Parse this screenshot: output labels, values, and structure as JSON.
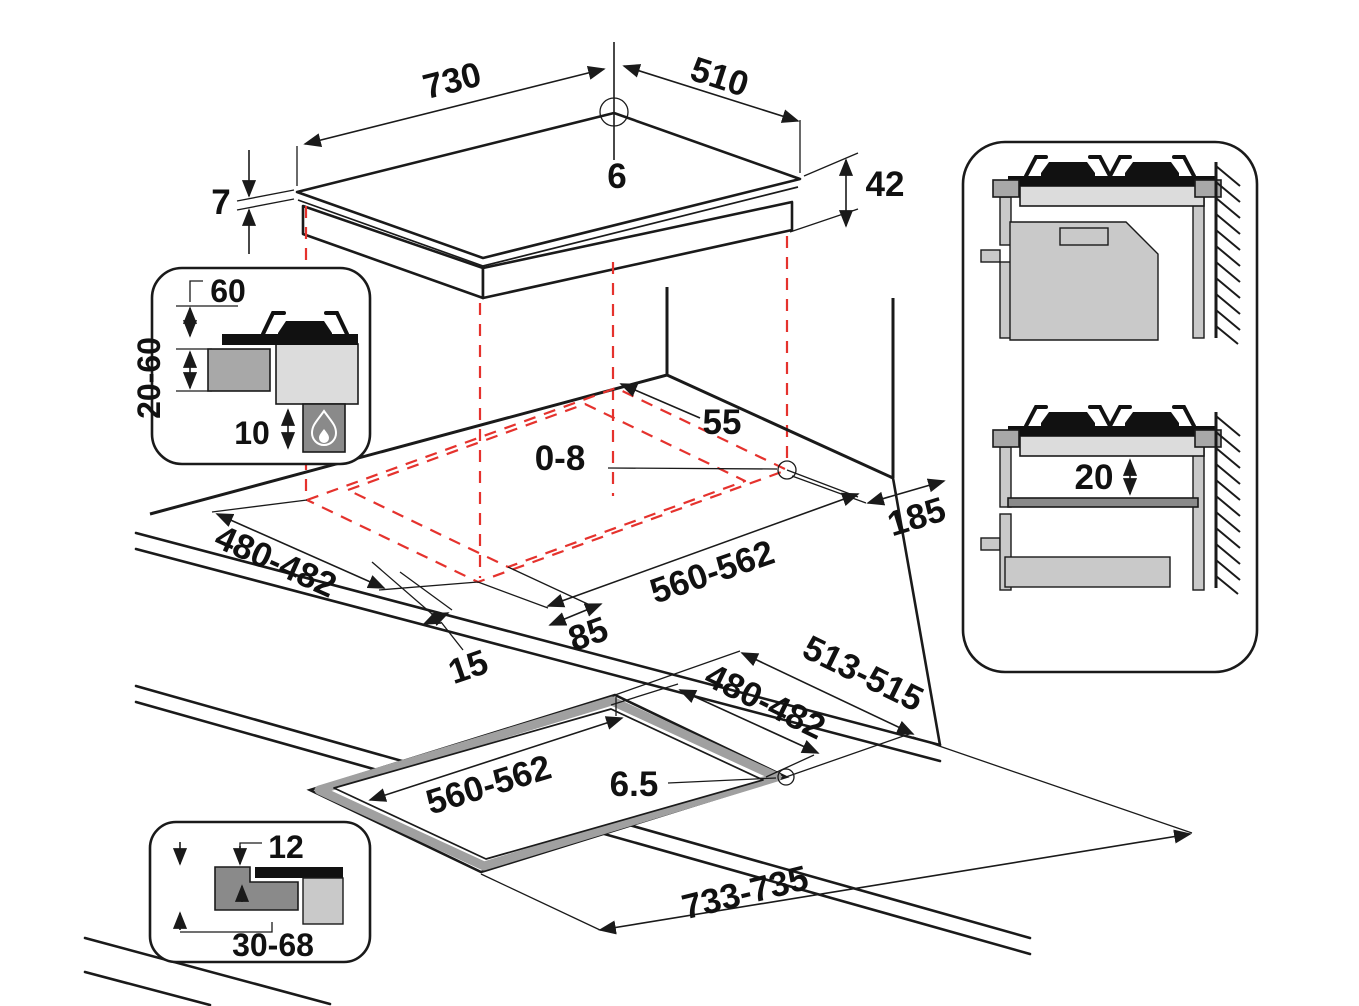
{
  "colors": {
    "line": "#1a1a1a",
    "projection_red": "#e5322d",
    "gray_light": "#dcdcdc",
    "gray_mid": "#a8a8a8",
    "gray_dark": "#8a8a8a"
  },
  "hob_top_view": {
    "width": "730",
    "depth": "510",
    "corner_radius": "6",
    "glass_thickness": "7",
    "body_height": "42"
  },
  "cutout_view": {
    "rear_gap": "55",
    "corner_radius": "0-8",
    "side_clearance": "185",
    "cutout_depth": "480-482",
    "cutout_width": "560-562",
    "front_overhang": "85",
    "side_overhang": "15"
  },
  "clearance_inset": {
    "clearance_above": "60",
    "worktop_thickness": "20-60",
    "gap_below": "10"
  },
  "flush_view": {
    "recess_depth": "513-515",
    "cutout_depth": "480-482",
    "cutout_width": "560-562",
    "corner_radius": "6.5",
    "recess_width": "733-735"
  },
  "rebate_inset": {
    "rebate_depth": "12",
    "panel_thickness": "30-68"
  },
  "wall_section": {
    "shelf_gap": "20"
  }
}
